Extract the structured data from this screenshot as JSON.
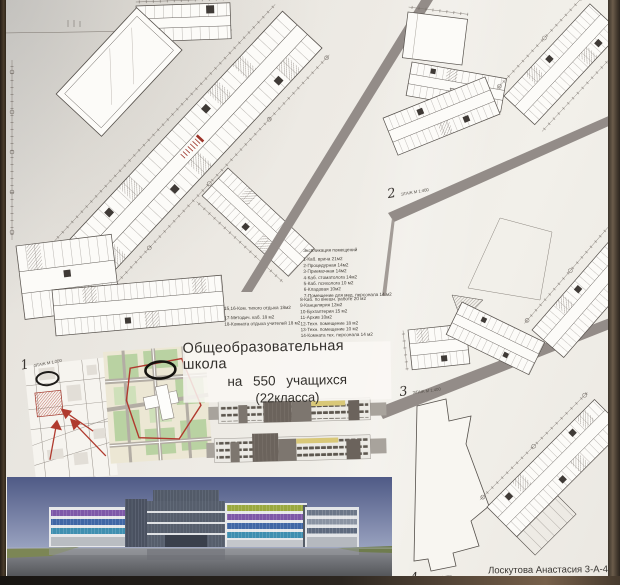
{
  "poster": {
    "title_line1": "Общеобразовательная школа",
    "title_line2": "на 550 учащихся",
    "title_line3": "(22класса)",
    "signature": "Лоскутова Анастасия 3-А-4"
  },
  "floor_labels": [
    {
      "num": "1",
      "scale": "ЭТАЖ М 1:200"
    },
    {
      "num": "2",
      "scale": "ЭТАЖ М 1:400"
    },
    {
      "num": "3",
      "scale": "ЭТАЖ М 1:400"
    },
    {
      "num": "4",
      "scale": "ЭТАЖ М 1:400"
    }
  ],
  "legend": {
    "header": "Экспликация помещений",
    "block1": [
      "1-Каб. врача 21м2",
      "2-Процедурная 14м2",
      "3-Приемочная 14м2",
      "4-Каб. стоматолога 14м2",
      "5-Каб. психолога 10 м2",
      "6-Кладовая 10м2",
      "7-Помещение для мед. персонала 14 м2"
    ],
    "block2": [
      "8-Каб. по внешн. работе 20 м2",
      "9-Канцелярия 12м2",
      "10-Бухгалтерия 15 м2",
      "11-Архив 10м2",
      "12-Техн. помещение 18 м2",
      "13-Техн. помещение 10 м2",
      "14-Комната тех. персонала 14 м2"
    ],
    "block3": [
      "15,16-Ком. тихого отдыха 18м2",
      "17-Методич. каб. 18 м2",
      "18-Комната отдыха учителей 18 м2"
    ]
  },
  "colors": {
    "band_gray": "#938c88",
    "plan_line": "#55504b",
    "accent_red": "#a33b2f",
    "elevation_yellow": "#d9c878",
    "render_purple": "#7e58a8",
    "render_blue": "#4167a5",
    "render_teal": "#3f8fb0",
    "render_lime": "#9aa83e",
    "sky_top": "#4f5a86"
  }
}
